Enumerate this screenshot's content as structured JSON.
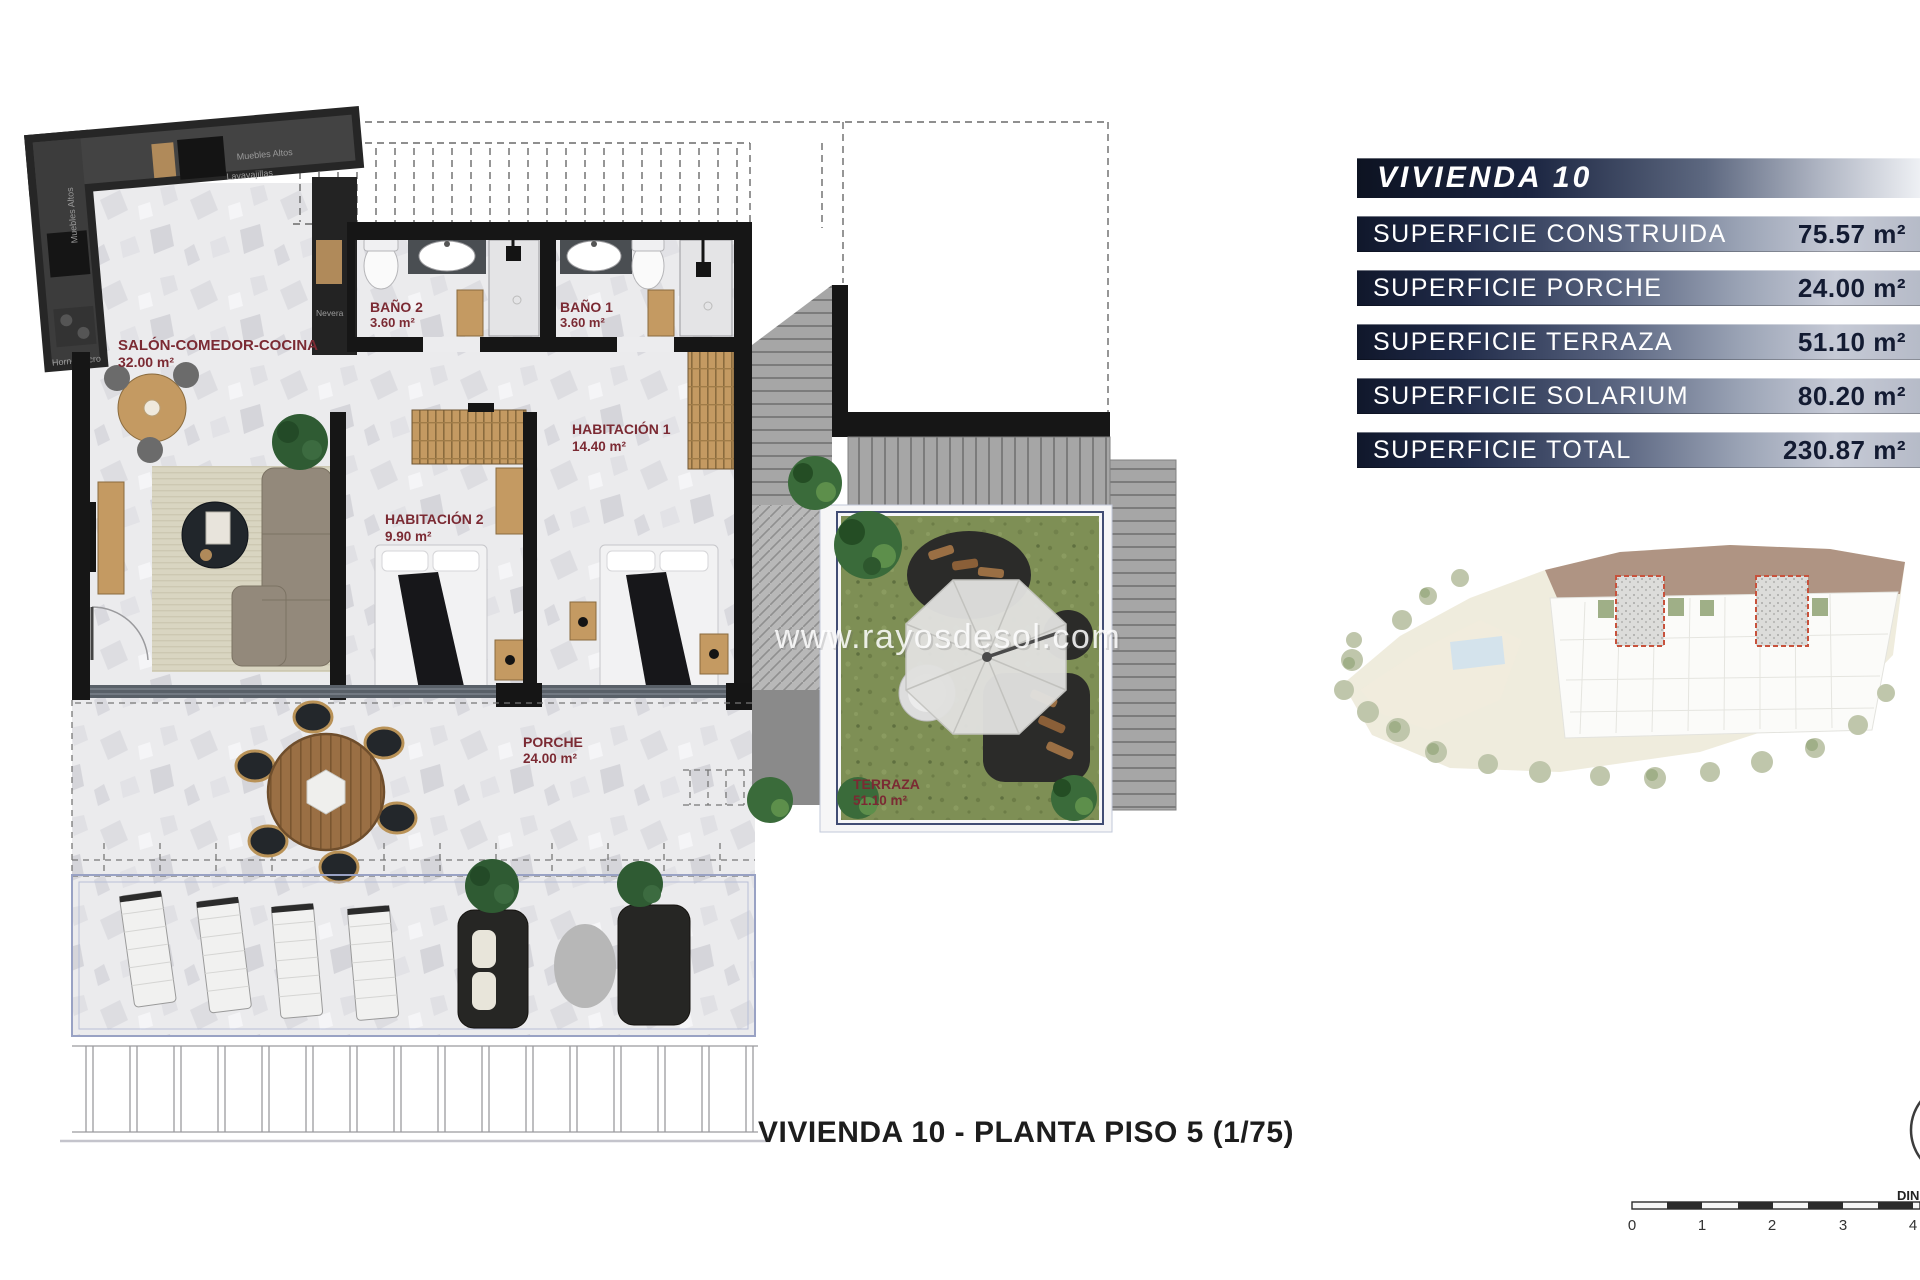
{
  "panel": {
    "title": "VIVIENDA 10",
    "rows": [
      {
        "label": "SUPERFICIE CONSTRUIDA",
        "value": "75.57 m²"
      },
      {
        "label": "SUPERFICIE PORCHE",
        "value": "24.00 m²"
      },
      {
        "label": "SUPERFICIE TERRAZA",
        "value": "51.10 m²"
      },
      {
        "label": "SUPERFICIE SOLARIUM",
        "value": "80.20 m²"
      }
    ],
    "total": {
      "label": "SUPERFICIE TOTAL",
      "value": "230.87 m²"
    },
    "colors": {
      "bar_dark": "#141c33",
      "bar_light": "#c6cad6",
      "value_text": "#131b32",
      "label_text": "#ffffff"
    }
  },
  "plan": {
    "rooms": [
      {
        "label": "SALÓN-COMEDOR-COCINA",
        "area": "32.00 m²"
      },
      {
        "label": "BAÑO 2",
        "area": "3.60 m²"
      },
      {
        "label": "BAÑO 1",
        "area": "3.60 m²"
      },
      {
        "label": "HABITACIÓN 1",
        "area": "14.40 m²"
      },
      {
        "label": "HABITACIÓN 2",
        "area": "9.90 m²"
      },
      {
        "label": "PORCHE",
        "area": "24.00 m²"
      },
      {
        "label": "TERRAZA",
        "area": "51.10 m²"
      }
    ],
    "kitchen_labels": [
      "Muebles Altos",
      "Lavavajillas",
      "Muebles Altos",
      "Horno/Micro",
      "Nevera"
    ],
    "colors": {
      "room_label": "#7b2a33",
      "wall": "#161616",
      "grass": "#7e8f55",
      "wood": "#c49a62",
      "highlight_dashed": "#c03b22"
    }
  },
  "watermark": {
    "text": "www.rayosdesol.com"
  },
  "caption": {
    "text": "VIVIENDA 10 - PLANTA PISO 5 (1/75)"
  },
  "scalebar": {
    "ticks": [
      "0",
      "1",
      "2",
      "3",
      "4"
    ],
    "din_label": "DIN"
  }
}
